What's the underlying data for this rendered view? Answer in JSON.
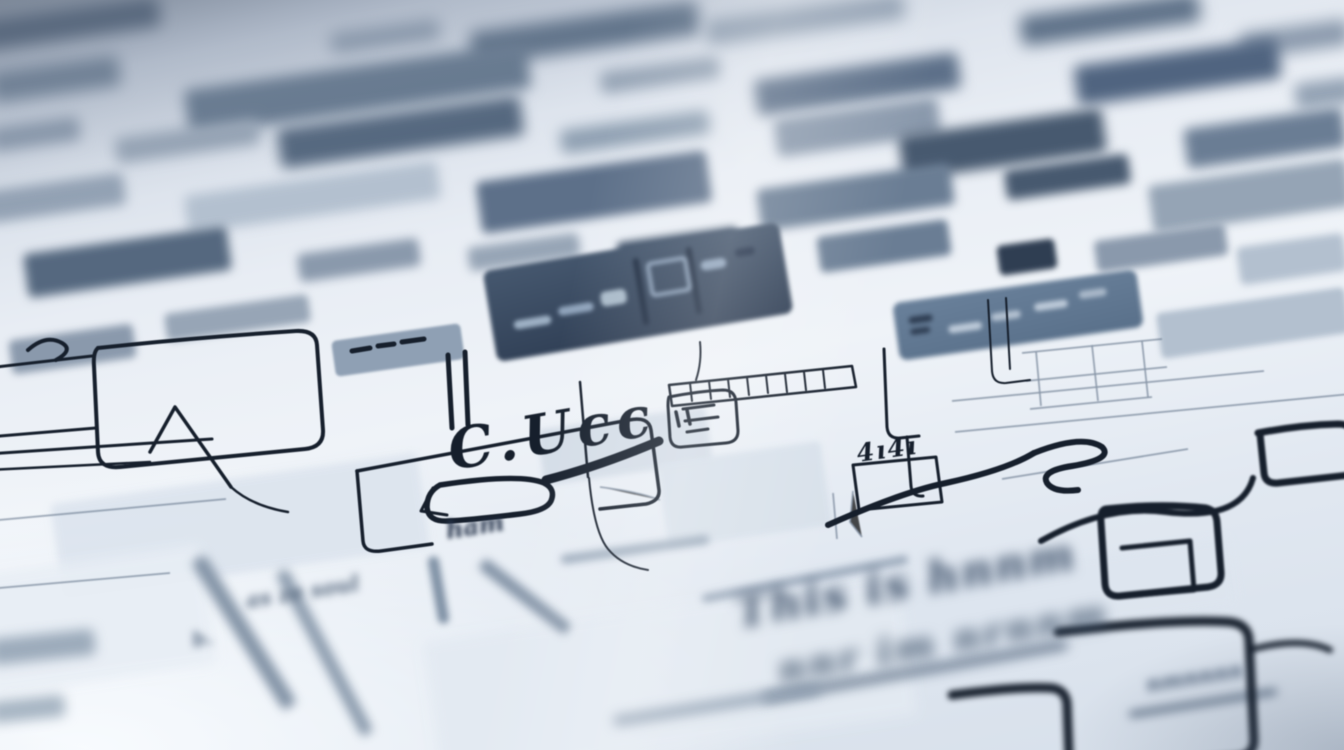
{
  "palette": {
    "paper": "#eef2f7",
    "paper_cool": "#dde5ef",
    "haze_dark": "#8793a3",
    "ink": "#161f2c",
    "ink_soft": "#2c3a4c",
    "slate": "#6d8198",
    "slate_dark": "#49596e",
    "slate_deep": "#33415a",
    "slate_light": "#9fb0c2",
    "slab_light": "#cdd7e2",
    "gray_stroke": "#8293a6"
  },
  "labels": {
    "main_scribble": "C.Ucc",
    "box_scribble": "4ı4ı",
    "left_scribble": "ham",
    "mid_scribble": "as ze soul",
    "small_scribble": "b.",
    "bottom_line1": "This is hnnm",
    "bottom_line2": "nnr im nrnnm",
    "bottom_line3": "nmnnnn"
  },
  "light_slabs": [
    {
      "x": 540,
      "y": 418,
      "w": 170,
      "h": 56,
      "c": "#d2dbe6",
      "bl": 3,
      "op": 0.9
    },
    {
      "x": 662,
      "y": 452,
      "w": 165,
      "h": 85,
      "c": "#d7e0ea",
      "bl": 3,
      "op": 0.9
    },
    {
      "x": 55,
      "y": 478,
      "w": 370,
      "h": 95,
      "c": "#dce4ee",
      "bl": 4,
      "op": 0.9
    },
    {
      "x": 430,
      "y": 608,
      "w": 480,
      "h": 140,
      "c": "#e3eaf2",
      "bl": 6,
      "op": 0.9
    },
    {
      "x": 905,
      "y": 560,
      "w": 330,
      "h": 70,
      "c": "#dde5ef",
      "bl": 5,
      "op": 0.85
    },
    {
      "x": -20,
      "y": 560,
      "w": 230,
      "h": 120,
      "c": "#e8eef5",
      "bl": 6,
      "op": 0.9
    }
  ],
  "background_bars": [
    {
      "x": -20,
      "y": 8,
      "w": 180,
      "h": 30,
      "c": "#4e6077",
      "bl": 8
    },
    {
      "x": 330,
      "y": 26,
      "w": 110,
      "h": 20,
      "c": "#8a99ac",
      "bl": 8
    },
    {
      "x": 470,
      "y": 16,
      "w": 230,
      "h": 34,
      "c": "#5f7289",
      "bl": 8
    },
    {
      "x": 705,
      "y": 6,
      "w": 200,
      "h": 26,
      "c": "#93a2b4",
      "bl": 8
    },
    {
      "x": 1020,
      "y": 4,
      "w": 180,
      "h": 30,
      "c": "#5f7289",
      "bl": 8
    },
    {
      "x": 1240,
      "y": 26,
      "w": 110,
      "h": 26,
      "c": "#8a99ac",
      "bl": 8
    },
    {
      "x": -10,
      "y": 64,
      "w": 130,
      "h": 30,
      "c": "#6c7e93",
      "bl": 8
    },
    {
      "x": 185,
      "y": 66,
      "w": 345,
      "h": 46,
      "c": "#66798f",
      "bl": 7
    },
    {
      "x": 600,
      "y": 64,
      "w": 120,
      "h": 22,
      "c": "#97a5b6",
      "bl": 7
    },
    {
      "x": 755,
      "y": 66,
      "w": 205,
      "h": 36,
      "c": "#5d7089",
      "bl": 7
    },
    {
      "x": 1075,
      "y": 52,
      "w": 205,
      "h": 40,
      "c": "#506480",
      "bl": 7
    },
    {
      "x": 1295,
      "y": 80,
      "w": 60,
      "h": 26,
      "c": "#93a2b4",
      "bl": 7
    },
    {
      "x": -10,
      "y": 122,
      "w": 90,
      "h": 24,
      "c": "#8a99ac",
      "bl": 7
    },
    {
      "x": 115,
      "y": 128,
      "w": 145,
      "h": 26,
      "c": "#97a5b6",
      "bl": 7
    },
    {
      "x": 278,
      "y": 112,
      "w": 245,
      "h": 40,
      "c": "#55687f",
      "bl": 7
    },
    {
      "x": 560,
      "y": 120,
      "w": 150,
      "h": 24,
      "c": "#8fa0b2",
      "bl": 7
    },
    {
      "x": 775,
      "y": 108,
      "w": 165,
      "h": 38,
      "c": "#8a99ac",
      "bl": 6
    },
    {
      "x": 900,
      "y": 122,
      "w": 205,
      "h": 44,
      "c": "#47596f",
      "bl": 6
    },
    {
      "x": 1185,
      "y": 118,
      "w": 160,
      "h": 40,
      "c": "#6a7d94",
      "bl": 6
    },
    {
      "x": -15,
      "y": 182,
      "w": 140,
      "h": 32,
      "c": "#93a2b4",
      "bl": 6
    },
    {
      "x": 185,
      "y": 178,
      "w": 255,
      "h": 38,
      "c": "#b3c0cf",
      "bl": 6
    },
    {
      "x": 478,
      "y": 166,
      "w": 232,
      "h": 52,
      "c": "#5d7089",
      "bl": 5
    },
    {
      "x": 758,
      "y": 176,
      "w": 195,
      "h": 42,
      "c": "#6a7d94",
      "bl": 5
    },
    {
      "x": 1005,
      "y": 162,
      "w": 125,
      "h": 30,
      "c": "#47596f",
      "bl": 5
    },
    {
      "x": 1150,
      "y": 172,
      "w": 200,
      "h": 48,
      "c": "#95a4b5",
      "bl": 5
    },
    {
      "x": 25,
      "y": 240,
      "w": 205,
      "h": 44,
      "c": "#55687f",
      "bl": 5
    },
    {
      "x": 298,
      "y": 246,
      "w": 122,
      "h": 28,
      "c": "#8a99ac",
      "bl": 5
    },
    {
      "x": 468,
      "y": 240,
      "w": 112,
      "h": 24,
      "c": "#97a5b6",
      "bl": 5
    },
    {
      "x": 618,
      "y": 234,
      "w": 122,
      "h": 34,
      "c": "#3f5168",
      "bl": 4
    },
    {
      "x": 818,
      "y": 228,
      "w": 132,
      "h": 36,
      "c": "#6a7d94",
      "bl": 4
    },
    {
      "x": 998,
      "y": 242,
      "w": 58,
      "h": 30,
      "c": "#2f3e52",
      "bl": 3
    },
    {
      "x": 1095,
      "y": 232,
      "w": 132,
      "h": 32,
      "c": "#8a99ac",
      "bl": 4
    },
    {
      "x": 1238,
      "y": 240,
      "w": 108,
      "h": 38,
      "c": "#b3c0cf",
      "bl": 4
    },
    {
      "x": 165,
      "y": 304,
      "w": 145,
      "h": 28,
      "c": "#97a5b6",
      "bl": 4
    },
    {
      "x": 10,
      "y": 332,
      "w": 125,
      "h": 34,
      "c": "#8a99ac",
      "bl": 4
    },
    {
      "x": 1158,
      "y": 300,
      "w": 190,
      "h": 46,
      "c": "#b3c0cf",
      "bl": 3
    },
    {
      "x": 333,
      "y": 332,
      "w": 130,
      "h": 36,
      "c": "#8fa0b4",
      "bl": 1.2
    }
  ],
  "toolbar_panel": {
    "x": 488,
    "y": 246,
    "w": 300,
    "h": 92,
    "rot": -9.5,
    "blur": 2.2,
    "fill_top": "#46586f",
    "fill_bottom": "#2d3c52",
    "marks": [
      {
        "x": 22,
        "y": 54,
        "w": 38,
        "h": 9,
        "c": "#9db0c4",
        "rot": 0
      },
      {
        "x": 68,
        "y": 48,
        "w": 36,
        "h": 9,
        "c": "#8fa3bb",
        "rot": 0
      },
      {
        "x": 112,
        "y": 40,
        "w": 26,
        "h": 15,
        "c": "#a9bac9",
        "rot": 0
      },
      {
        "x": 150,
        "y": 12,
        "w": 6,
        "h": 68,
        "c": "#1f2d42",
        "rot": 0
      },
      {
        "x": 162,
        "y": 18,
        "w": 34,
        "h": 28,
        "c": "#8fa3bb",
        "rot": 0,
        "hollow": true
      },
      {
        "x": 204,
        "y": 10,
        "w": 6,
        "h": 68,
        "c": "#1f2d42",
        "rot": 0
      },
      {
        "x": 216,
        "y": 26,
        "w": 26,
        "h": 10,
        "c": "#8fa3bb",
        "rot": 0
      },
      {
        "x": 252,
        "y": 20,
        "w": 20,
        "h": 8,
        "c": "#23324a",
        "rot": 0
      }
    ]
  },
  "side_panel": {
    "x": 895,
    "y": 286,
    "w": 246,
    "h": 58,
    "rot": -8,
    "blur": 2.4,
    "fill_top": "#69809a",
    "fill_bottom": "#59708a",
    "marks": [
      {
        "x": 14,
        "y": 16,
        "w": 24,
        "h": 7,
        "c": "#2e3d52",
        "rot": 0
      },
      {
        "x": 14,
        "y": 28,
        "w": 20,
        "h": 6,
        "c": "#2e3d52",
        "rot": 0
      },
      {
        "x": 52,
        "y": 30,
        "w": 34,
        "h": 8,
        "c": "#bcc9d8",
        "rot": 0
      },
      {
        "x": 96,
        "y": 24,
        "w": 30,
        "h": 8,
        "c": "#b2c0d0",
        "rot": 0
      },
      {
        "x": 140,
        "y": 20,
        "w": 34,
        "h": 8,
        "c": "#bcc9d8",
        "rot": 0
      },
      {
        "x": 186,
        "y": 14,
        "w": 28,
        "h": 8,
        "c": "#a9b8c9",
        "rot": 0
      }
    ]
  },
  "foreground_strokes": [
    {
      "x": 236,
      "y": 545,
      "w": 16,
      "h": 175,
      "c": "#8494a7",
      "bl": 5,
      "rot": -32
    },
    {
      "x": 318,
      "y": 560,
      "w": 13,
      "h": 185,
      "c": "#8a9aac",
      "bl": 5,
      "rot": -28
    },
    {
      "x": 433,
      "y": 556,
      "w": 11,
      "h": 68,
      "c": "#7e90a4",
      "bl": 3.5,
      "rot": -10
    },
    {
      "x": 470,
      "y": 590,
      "w": 110,
      "h": 13,
      "c": "#8494a7",
      "bl": 4.5,
      "rot": 38
    },
    {
      "x": 560,
      "y": 545,
      "w": 150,
      "h": 9,
      "c": "#9aa9ba",
      "bl": 4,
      "rot": -8
    },
    {
      "x": 700,
      "y": 575,
      "w": 210,
      "h": 8,
      "c": "#95a4b6",
      "bl": 4,
      "rot": -11
    },
    {
      "x": 760,
      "y": 668,
      "w": 310,
      "h": 7,
      "c": "#4c5f77",
      "bl": 6,
      "rot": -10
    },
    {
      "x": 1128,
      "y": 700,
      "w": 150,
      "h": 6,
      "c": "#56687e",
      "bl": 5,
      "rot": -9
    },
    {
      "x": -10,
      "y": 634,
      "w": 105,
      "h": 26,
      "c": "#9cabbb",
      "bl": 6,
      "rot": -6
    },
    {
      "x": -10,
      "y": 698,
      "w": 75,
      "h": 22,
      "c": "#a7b5c3",
      "bl": 6,
      "rot": -6
    },
    {
      "x": 612,
      "y": 700,
      "w": 210,
      "h": 10,
      "c": "#8e9eb0",
      "bl": 6,
      "rot": -9
    }
  ]
}
